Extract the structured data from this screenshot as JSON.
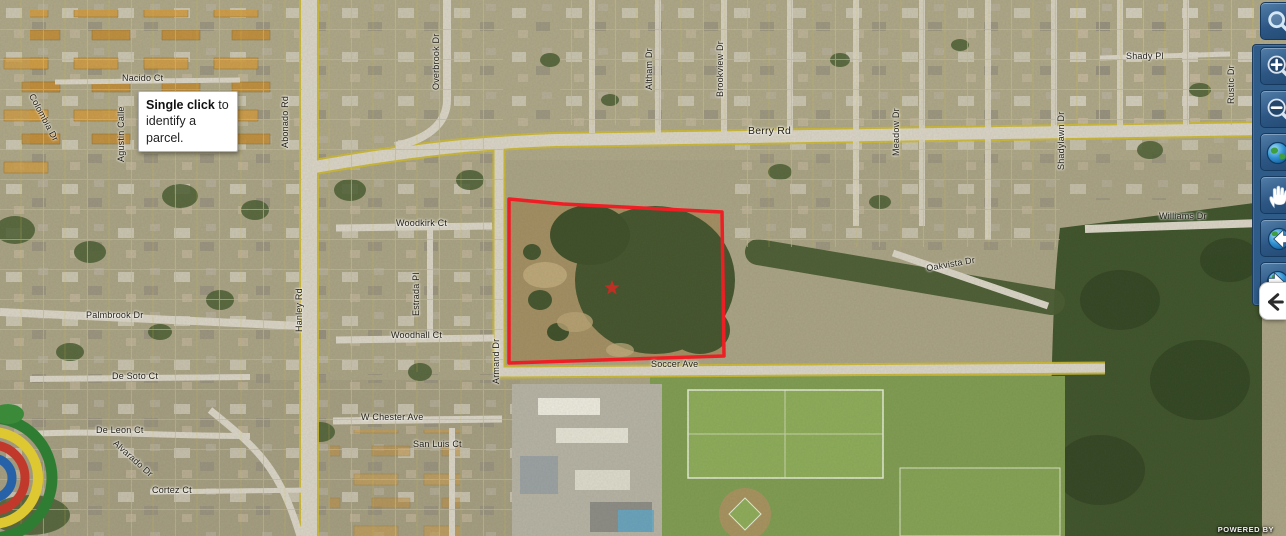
{
  "map": {
    "tooltip": {
      "bold": "Single click",
      "rest": " to identify a parcel."
    },
    "powered_by": "POWERED BY",
    "street_labels": [
      "Nacido Ct",
      "Abonado Rd",
      "Hanley Rd",
      "Berry Rd",
      "Woodkirk Ct",
      "Estrada Pl",
      "Woodhall Ct",
      "Armand Dr",
      "Soccer Ave",
      "Williams Dr",
      "Oakvista Dr",
      "Shady Pl",
      "Rustic Dr",
      "Overbrook Dr",
      "Altham Dr",
      "Brookview Dr",
      "Meadow Dr",
      "Shadylawn Dr",
      "De Soto Ct",
      "De Leon Ct",
      "Cortez Ct",
      "W Chester Ave",
      "San Luis Ct",
      "Palmbrook Dr",
      "Agustin Calle",
      "Colombia Dr",
      "Alvarado Dr"
    ],
    "colors": {
      "parcel_outline": "#ee1f24",
      "parcel_grid_lines": "#d6c23a",
      "toolbar_background": "#2f5b89",
      "tooltip_background": "#ffffff"
    }
  },
  "toolbar": {
    "icons": [
      "search-icon",
      "zoom-in-icon",
      "zoom-out-icon",
      "full-extent-globe-icon",
      "pan-hand-icon",
      "previous-extent-icon",
      "next-extent-icon",
      "collapse-left-icon"
    ]
  }
}
